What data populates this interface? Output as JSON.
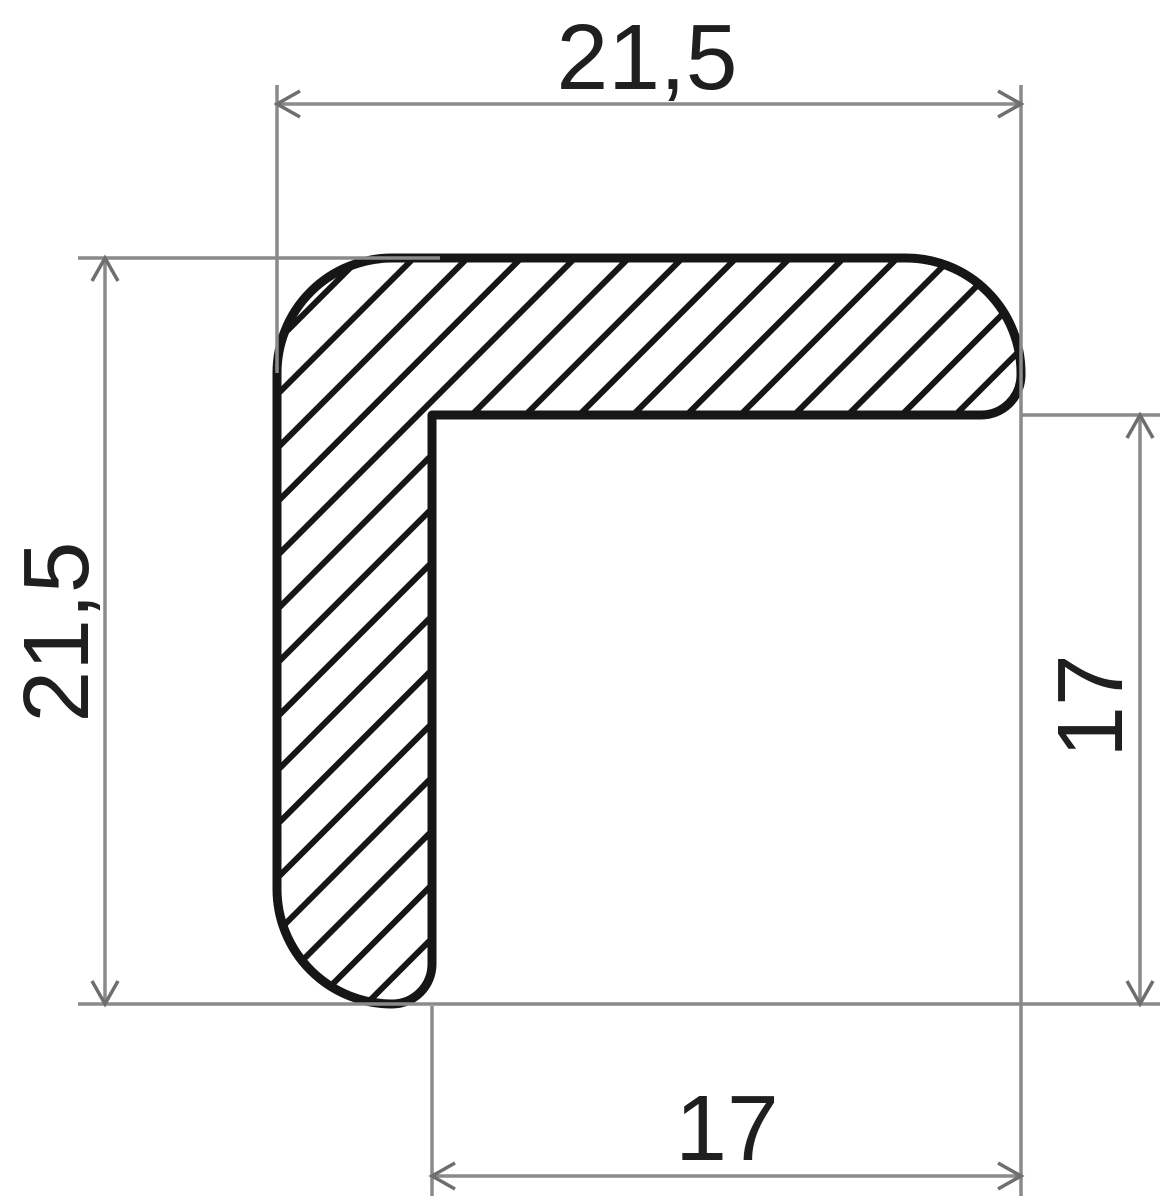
{
  "drawing": {
    "kind": "profile-cross-section",
    "dimensions": {
      "top": "21,5",
      "left": "21,5",
      "right": "17",
      "bottom": "17"
    },
    "colors": {
      "outline": "#161616",
      "hatch": "#161616",
      "dimension_lines": "#8a8a8a",
      "label_text": "#1f1f1f",
      "background": "#ffffff"
    }
  }
}
